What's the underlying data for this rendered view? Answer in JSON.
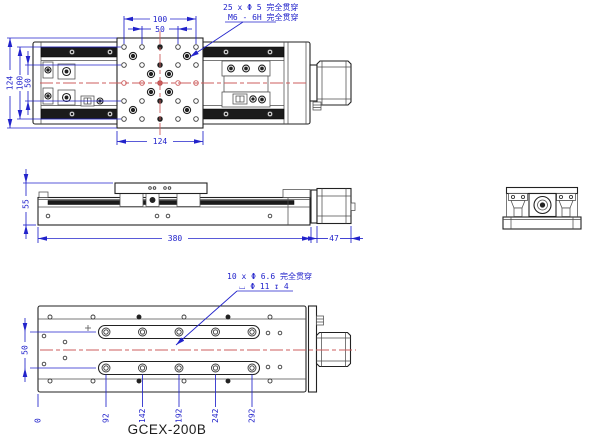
{
  "drawing": {
    "title": "GCEX-200B",
    "colors": {
      "dimension": "#2223cb",
      "centerline": "#cd5c5c",
      "outline": "#222222"
    },
    "top_view": {
      "note_line1": "25 x Φ 5 完全贯穿",
      "note_line2": "M6 - 6H 完全贯穿",
      "dim_top_outer": "100",
      "dim_top_inner": "50",
      "dim_left_outer": "124",
      "dim_left_mid": "100",
      "dim_left_inner": "50",
      "dim_bottom": "124"
    },
    "front_view": {
      "dim_height": "55",
      "dim_length": "380",
      "dim_motor_length": "47"
    },
    "bottom_view": {
      "note_line1": "10 x Φ 6.6 完全贯穿",
      "note_line2": "⌴ Φ 11 ↧ 4",
      "dim_slot_spacing": "50",
      "ordinates": [
        "0",
        "92",
        "142",
        "192",
        "242",
        "292"
      ]
    }
  }
}
